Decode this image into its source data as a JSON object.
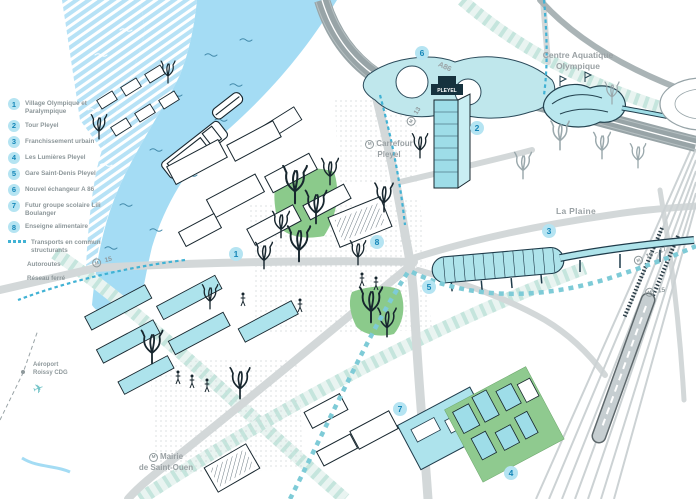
{
  "legend": {
    "items": [
      {
        "num": "1",
        "label": "Village Olympique et Paralympique"
      },
      {
        "num": "2",
        "label": "Tour Pleyel"
      },
      {
        "num": "3",
        "label": "Franchissement urbain"
      },
      {
        "num": "4",
        "label": "Les Lumières Pleyel"
      },
      {
        "num": "5",
        "label": "Gare Saint-Denis Pleyel"
      },
      {
        "num": "6",
        "label": "Nouvel échangeur A 86"
      },
      {
        "num": "7",
        "label": "Futur groupe scolaire Lili Boulanger"
      },
      {
        "num": "8",
        "label": "Enseigne alimentaire"
      }
    ],
    "lines": [
      {
        "type": "dotted",
        "label": "Transports en commun structurants"
      },
      {
        "type": "autoroute",
        "label": "Autoroutes"
      },
      {
        "type": "rail",
        "label": "Réseau ferré"
      }
    ]
  },
  "labels": {
    "centre_aquatique": "Centre Aquatique Olympique",
    "carrefour_pleyel": "Carrefour Pleyel",
    "la_plaine": "La Plaine",
    "mairie_line1": "Mairie",
    "mairie_line2": "de Saint-Ouen",
    "a86": "A86",
    "airport_line1": "Aéroport",
    "airport_line2": "Roissy CDG",
    "metro_letter": "M",
    "tour_pleyel_sign": "PLEYEL"
  },
  "badges": [
    {
      "m": "M",
      "num": "13"
    },
    {
      "m": "M",
      "num": "15"
    },
    {
      "m": "M",
      "num": "16 – 17"
    },
    {
      "m": "M",
      "num": "15"
    }
  ],
  "markers": [
    {
      "n": "1"
    },
    {
      "n": "2"
    },
    {
      "n": "3"
    },
    {
      "n": "4"
    },
    {
      "n": "5"
    },
    {
      "n": "6"
    },
    {
      "n": "7"
    },
    {
      "n": "8"
    }
  ],
  "colors": {
    "accent_blue": "#1486b8",
    "marker_fill": "#b5e4f2",
    "transit_teal": "#41b2d4",
    "building_teal": "#ade3ec",
    "green": "#8fca8f",
    "river_blue": "#a4dcf4",
    "road_gray": "#d3d8d9",
    "label_gray": "#9aa1a4"
  }
}
